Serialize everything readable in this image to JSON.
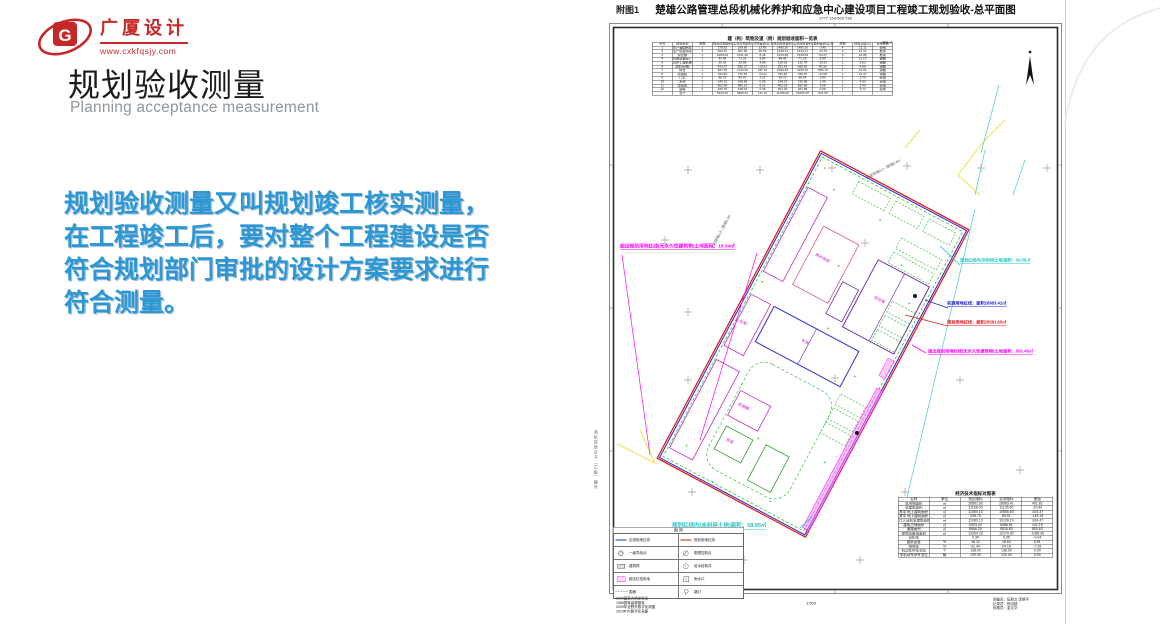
{
  "slide": {
    "logo": {
      "brand": "广厦设计",
      "website": "www.cxkfqsjy.com",
      "mark": "G"
    },
    "title": "规划验收测量",
    "subtitle": "Planning acceptance measurement",
    "body_lines": [
      "规划验收测量又叫规划竣工核实测量，",
      "在工程竣工后，要对整个工程建设是否",
      "符合规划部门审批的设计方案要求进行",
      "符合测量。"
    ],
    "accent_color": "#2b98d5",
    "brand_color": "#c62828"
  },
  "drawing": {
    "fig_label": "附图1",
    "title": "楚雄公路管理总段机械化养护和应急中心建设项目工程竣工规划验收-总平面图",
    "subtitle": "2777.154-600.738",
    "scale_label": "1:500",
    "compass": "北",
    "annotations": {
      "over_line_left": "超出规划用地红线(无永久性建筑物)土地面积：18.34㎡",
      "unused_top": "规划红线内(未利用土地)面积：59.08㎡",
      "measured_line": "实测用地红线：面积28983.41㎡",
      "planned_line": "规划用地红线：面积28581.60㎡",
      "over_line_right": "超出规划用地红线(无永久性建筑物)土地面积：502.46㎡",
      "unused_bottom": "规划红线内(未利用土地)面积：58.95㎡"
    },
    "boundary_notes": [
      "水泥砖墙0.3—围墙0.4m",
      "水泥砖墙0.2—围墙0.4m"
    ],
    "plan_labels": [
      "综合楼",
      "养护用房",
      "车库",
      "仓库",
      "机械棚",
      "食堂"
    ],
    "colors": {
      "measured": "#2020d0",
      "planned": "#e02020",
      "unused": "#20c8c8",
      "over": "#ff00ff",
      "green": "#28b428"
    },
    "area_table": {
      "title": "建（构）筑物及道（附）规划验收面积一览表",
      "unit_note": "单位:㎡",
      "headers": [
        "序号",
        "建筑名称",
        "层数",
        "规划占地面积",
        "实测占地面积",
        "占地差值(实-规)",
        "规划建筑面积",
        "实测建筑面积",
        "面积差值(实-规)",
        "层数",
        "建筑高度(m)",
        "使用性质"
      ],
      "rows": [
        [
          "1",
          "生产辅助用房",
          "1",
          "278.82",
          "189.90",
          "13.45",
          "1485.50",
          "1485.30",
          "-3.45",
          "4",
          "12.11",
          "轻钢"
        ],
        [
          "2",
          "生产配套用房",
          "1",
          "462.51",
          "461.90",
          "20.59",
          "1439.41",
          "1434.71",
          "-14.70",
          "4",
          "12.14",
          "框架"
        ],
        [
          "3",
          "综合楼",
          "1",
          "1063.03",
          "1131.46",
          "8.46",
          "2134.80",
          "2130.83",
          "-64.27",
          "4",
          "12.08",
          "框架"
        ],
        [
          "4",
          "机械设备库(厂)",
          "1",
          "93.48",
          "71.33",
          "3.84",
          "88.48",
          "72.18",
          "8.90",
          "1",
          "11.13",
          "钢棚"
        ],
        [
          "5",
          "养护工程机械停放棚",
          "1",
          "30.92",
          "33.88",
          "3.88",
          "130.03",
          "132.78",
          "-19.33",
          "1",
          "5.82",
          "钢棚"
        ],
        [
          "6",
          "洗车台(棚)",
          "1",
          "543.27",
          "508.27",
          "-18.33",
          "831.43",
          "830.83",
          "40.36",
          "1",
          "8.98",
          "钢棚"
        ],
        [
          "7",
          "料仓",
          "1",
          "997.25",
          "1134.46",
          "237.22",
          "1994.83",
          "1109.31",
          "-883.79",
          "1",
          "14.04",
          "钢棚"
        ],
        [
          "8",
          "加油站",
          "1",
          "784.82",
          "770.53",
          "-14.41",
          "784.83",
          "788.87",
          "-13.08",
          "1",
          "13.47",
          "钢棚"
        ],
        [
          "9",
          "门卫",
          "1",
          "88.75",
          "83.57",
          "3.37",
          "83.75",
          "85.54",
          "3.94",
          "1",
          "3.75",
          "砖混"
        ],
        [
          "10",
          "水池",
          "1",
          "148.15",
          "148.88",
          "0.08",
          "148.13",
          "135.88",
          "1.48",
          "1",
          "4.54",
          "砖混"
        ],
        [
          "11",
          "垃圾房",
          "1",
          "802.08",
          "896.21",
          "6.21",
          "862.03",
          "892.90",
          "5.08",
          "1",
          "5.40",
          "砖混"
        ],
        [
          "12",
          "围墙",
          "1",
          "180.78",
          "198.04",
          "0.38",
          "281.03",
          "281.88",
          "0.08",
          "1",
          "3.74",
          "砖砌"
        ],
        [
          "",
          "合计",
          "",
          "5323.40",
          "5486.81",
          "141.15",
          "11156.00",
          "10206.00",
          "-901.55",
          "",
          "",
          ""
        ]
      ]
    },
    "econ_table": {
      "title": "经济技术指标对照表",
      "headers": [
        "名称",
        "单位",
        "规划指标",
        "实测指标",
        "差值"
      ],
      "rows": [
        [
          "总用地面积",
          "㎡",
          "28581.60",
          "28983.41",
          "401.81"
        ],
        [
          "总建筑面积",
          "㎡",
          "11156.00",
          "11135.60",
          "-20.40"
        ],
        [
          "其中 地上建筑面积",
          "㎡",
          "11080.10",
          "10555.60",
          "-524.47"
        ],
        [
          "其中 地下建筑面积",
          "㎡",
          "228.70",
          "85.51",
          "-143.19"
        ],
        [
          "计入容积率建筑面积",
          "㎡",
          "11080.10",
          "10128.10",
          "-924.47"
        ],
        [
          "建筑占地面积",
          "㎡",
          "5323.40",
          "5486.81",
          "141.15"
        ],
        [
          "道路面积",
          "㎡",
          "8966.20",
          "9816.83",
          "850.63"
        ],
        [
          "绿地及景观面积",
          "㎡",
          "13269.20",
          "12179.30",
          "-1089.90"
        ],
        [
          "容积率",
          "",
          "0.39",
          "0.35",
          "-0.04"
        ],
        [
          "建筑密度",
          "%",
          "18.12",
          "18.63",
          "0.51"
        ],
        [
          "绿地率",
          "%",
          "31.44",
          "24.18",
          "-7.26"
        ],
        [
          "机动车停车泊位",
          "个",
          "138.00",
          "138.00",
          "0.00"
        ],
        [
          "非机动车停车泊位",
          "辆",
          "120.00",
          "120.00",
          "0.00"
        ]
      ]
    },
    "legend": {
      "title": "图  例",
      "items": [
        {
          "sym": "line-blue",
          "label": "实测用地红线"
        },
        {
          "sym": "line-red",
          "label": "规划用地红线"
        },
        {
          "sym": "circle-hatch",
          "label": "一级导线点"
        },
        {
          "sym": "circle-cross",
          "label": "图根控制点"
        },
        {
          "sym": "rect-gray",
          "label": "建筑物"
        },
        {
          "sym": "circle-dot",
          "label": "给水检修井"
        },
        {
          "sym": "rect-pink",
          "label": "超出红线用地"
        },
        {
          "sym": "square-dot",
          "label": "雨水口"
        },
        {
          "sym": "dashdot",
          "label": "围墙"
        },
        {
          "sym": "lamp",
          "label": "路灯"
        }
      ]
    },
    "notes": [
      "2000国家大地坐标系",
      "1985国家高程基准",
      "2009年全野外数字化测图",
      "2019RTK数字化采集"
    ],
    "staff": [
      "测量员：伍勃文 李根平",
      "记录员：杨洪超",
      "校核员：金文华"
    ],
    "margin_note": "测绘资质证书（乙级）编号"
  }
}
